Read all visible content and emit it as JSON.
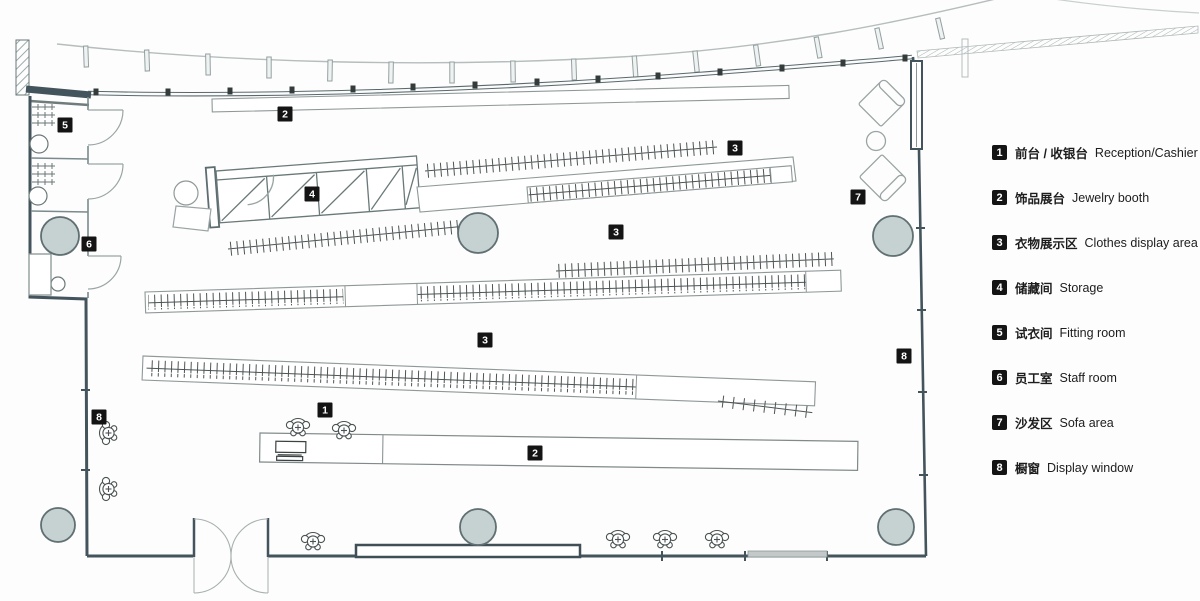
{
  "colors": {
    "wall": "#44545c",
    "partition": "#7b8b8d",
    "furniture": "#9aa4a4",
    "rack_tick": "#4d5454",
    "column_fill": "#c6d1d1",
    "column_stroke": "#5f6f72",
    "marker_bg": "#141414",
    "marker_text": "#ffffff",
    "canopy_line": "#b5bdbd"
  },
  "plan_markers": [
    {
      "label": "1"
    },
    {
      "label": "2"
    },
    {
      "label": "2"
    },
    {
      "label": "3"
    },
    {
      "label": "3"
    },
    {
      "label": "3"
    },
    {
      "label": "4"
    },
    {
      "label": "5"
    },
    {
      "label": "6"
    },
    {
      "label": "7"
    },
    {
      "label": "8"
    },
    {
      "label": "8"
    }
  ],
  "legend": {
    "items": [
      {
        "num": "1",
        "zh": "前台 / 收银台",
        "en": "Reception/Cashier"
      },
      {
        "num": "2",
        "zh": "饰品展台",
        "en": "Jewelry booth"
      },
      {
        "num": "3",
        "zh": "衣物展示区",
        "en": "Clothes display area"
      },
      {
        "num": "4",
        "zh": "储藏间",
        "en": "Storage"
      },
      {
        "num": "5",
        "zh": "试衣间",
        "en": "Fitting room"
      },
      {
        "num": "6",
        "zh": "员工室",
        "en": "Staff room"
      },
      {
        "num": "7",
        "zh": "沙发区",
        "en": "Sofa area"
      },
      {
        "num": "8",
        "zh": "橱窗",
        "en": "Display window"
      }
    ]
  }
}
